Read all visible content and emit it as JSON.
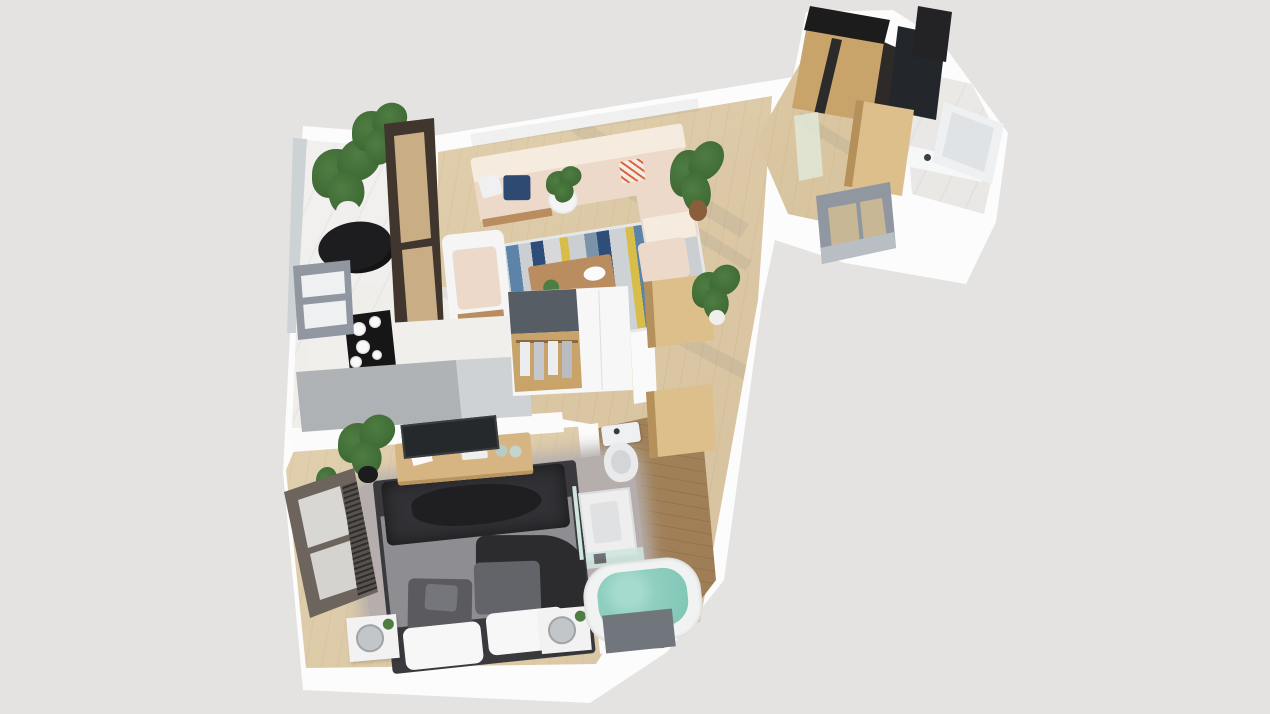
{
  "view": {
    "type": "3d-floor-plan-render",
    "style": "top-down isometric",
    "visible_text": "none"
  },
  "palette": {
    "background": "#e4e3e2",
    "wall": "#fcfcfc",
    "wall_shadow": "#ededee",
    "wood_floor": "#dbc7a4",
    "wood_floor_light": "#e7d7b7",
    "wood_floor_dark": "#9b7a52",
    "marble": "#f3f1ee",
    "balcony_floor": "#f1f0ee",
    "sofa_beige": "#ecd9ca",
    "sofa_back": "#f5ebdf",
    "cushion_navy": "#2e4a73",
    "rug_base": "#cbcfd2",
    "rug_blue": "#5b84a8",
    "rug_navy": "#2e4d78",
    "rug_yellow": "#d9bd49",
    "wood_furniture": "#b98d5f",
    "door_wood": "#dcbf8a",
    "counter_gray": "#a7abae",
    "counter_gray_light": "#cfd2d4",
    "cooktop_black": "#161617",
    "wardrobe_gray": "#575d65",
    "wardrobe_wood": "#c8a36a",
    "window_gray": "#9097a0",
    "window_brown": "#41362d",
    "window_glass_tan": "#c9ae85",
    "bedroom_window_frame": "#6e645e",
    "bed_dark": "#323236",
    "bed_darker": "#1f1f22",
    "bed_gray": "#8e8e92",
    "pillow_gray": "#5a5a5f",
    "pillow_white": "#f7f7f7",
    "shag_rug": "#b5aeac",
    "nightstand_white": "#f2f2f3",
    "mirror_gray": "#c2c6c9",
    "plant_green": "#4e7d42",
    "plant_green_dark": "#39622f",
    "pot_black": "#1c1c1e",
    "pot_white": "#f0efed",
    "bathtub_water": "#8fcfc0",
    "tub_white": "#f1f2f2",
    "tub_panel": "#70767b",
    "toilet_white": "#eef0f1",
    "glass_green": "#dfe8d8",
    "glass_teal": "#cfe6df",
    "mirror_dark": "#34383d",
    "black_top": "#1d1c1c",
    "balcony_set_black": "#1d1d1f"
  },
  "scene": {
    "rooms": [
      {
        "name": "balcony",
        "items": [
          "potted plants",
          "black bistro set",
          "dark sliding glass door"
        ]
      },
      {
        "name": "living-room",
        "items": [
          "beige corner sofa",
          "armchair",
          "wood coffee table",
          "blue-yellow striped rug",
          "side table with plant",
          "floor plant",
          "ottoman"
        ]
      },
      {
        "name": "kitchen",
        "items": [
          "gray counter",
          "marble worktop",
          "black cooktop with white dishes",
          "gray window",
          "wardrobe with hanging clothes"
        ]
      },
      {
        "name": "hallway",
        "items": [
          "open wooden doors",
          "potted plant",
          "gray window frame"
        ]
      },
      {
        "name": "bedroom",
        "items": [
          "double bed with dark duvet",
          "gray shag rug",
          "two nightstands with round mirrors",
          "media desk with screen",
          "tilted window with blinds",
          "potted plant"
        ]
      },
      {
        "name": "bathroom",
        "items": [
          "toilet",
          "shower tray",
          "glass shelf",
          "bathtub with teal water"
        ]
      },
      {
        "name": "entry",
        "items": [
          "wood wardrobe with black top",
          "dark mirror cabinet",
          "green glass partition",
          "open wood door"
        ]
      },
      {
        "name": "second-bathroom",
        "items": [
          "marble floor",
          "white glass door",
          "vanity with faucets"
        ]
      }
    ]
  }
}
